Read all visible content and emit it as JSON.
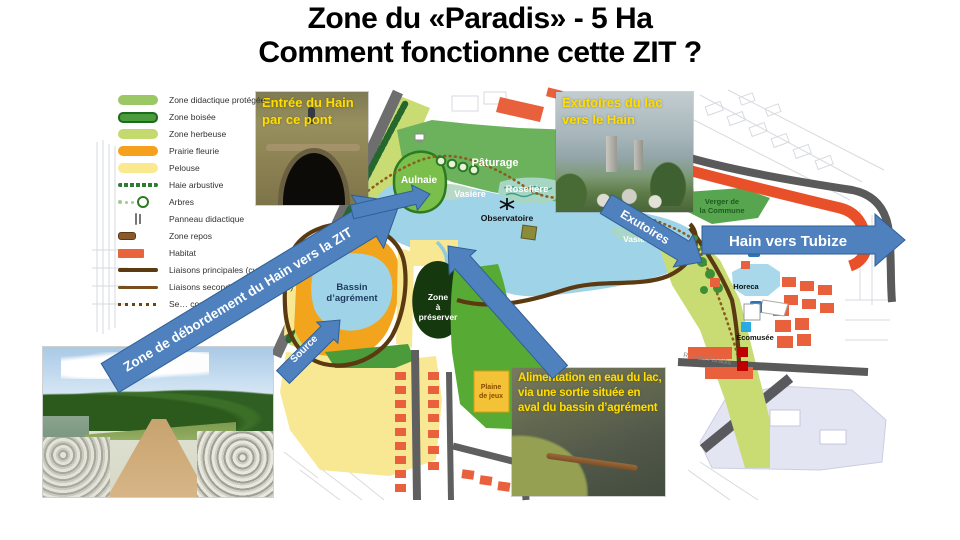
{
  "slide": {
    "title_line1": "Zone du «Paradis» - 5 Ha",
    "title_line2": "Comment fonctionne cette ZIT ?"
  },
  "colors": {
    "arrow_blue": "#4E81BD",
    "caption_yellow": "#FFDE00",
    "lake_blue": "#9FD4E8",
    "habitat_red": "#E8643C",
    "road_gray": "#5A5A5A",
    "path_brown": "#5C3A11"
  },
  "legend": {
    "items": [
      {
        "label": "Zone didactique protégée",
        "color": "#9BC764"
      },
      {
        "label": "Zone boisée",
        "color": "#4A9C3C"
      },
      {
        "label": "Zone herbeuse",
        "color": "#C4D96E"
      },
      {
        "label": "Prairie fleurie",
        "color": "#F5A11D"
      },
      {
        "label": "Pelouse",
        "color": "#FAE98F"
      },
      {
        "label": "Haie arbustive",
        "color": "#2E7D32"
      },
      {
        "label": "Arbres",
        "color": "#2E7A22"
      },
      {
        "label": "Panneau didactique",
        "color": "#777777"
      },
      {
        "label": "Zone repos",
        "color": "#8B5A2B"
      },
      {
        "label": "Habitat",
        "color": "#E8643C"
      },
      {
        "label": "Liaisons principales (cyclo-piétonnes)",
        "color": "#5C3A11"
      },
      {
        "label": "Liaisons secondaires (piétonnes)",
        "color": "#7A4E1C"
      },
      {
        "label": "Se… couverte",
        "color": "#6B4513"
      }
    ]
  },
  "photos": {
    "tunnel": {
      "caption_line1": "Entrée du Hain",
      "caption_line2": "par ce pont"
    },
    "outlet": {
      "caption_line1": "Exutoires du lac",
      "caption_line2": "vers le Hain"
    },
    "feed": {
      "caption_line1": "Alimentation en eau du lac,",
      "caption_line2": "via une sortie située en",
      "caption_line3": "aval du bassin d’agrément"
    }
  },
  "arrows": {
    "overflow_label": "Zone de débordement du Hain vers la ZIT",
    "exutoires_label": "Exutoires",
    "hain_tubize_label": "Hain vers Tubize",
    "source_label": "Source"
  },
  "map": {
    "labels": {
      "paturage": "Pâturage",
      "aulnaie": "Aulnaie",
      "vasiere_nord": "Vasière",
      "roseliere": "Roselière",
      "observatoire": "Observatoire",
      "vasiere_est": "Vasière",
      "verger_line1": "Verger de",
      "verger_line2": "la Commune",
      "bassin_line1": "Bassin",
      "bassin_line2": "d’agrément",
      "zone_line1": "Zone",
      "zone_line2": "à",
      "zone_line3": "préserver",
      "plaine_line1": "Plaine",
      "plaine_line2": "de jeux",
      "horeca": "Horeca",
      "ecomusee": "Écomusée",
      "rue_paradis": "Rue du Paradis",
      "parking": "P"
    }
  }
}
